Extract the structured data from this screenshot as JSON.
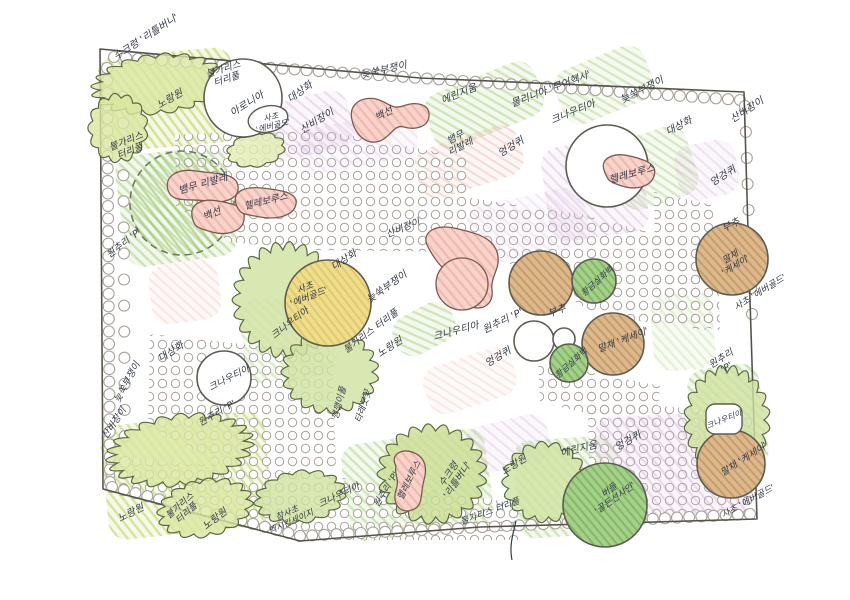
{
  "title": "planting-plan-sketch",
  "colors": {
    "ink": "#353b47",
    "outline": "#5d5c52",
    "border": "#55544c",
    "dot_stroke": "#a8a29a",
    "solid": {
      "green": "#b9d98e",
      "ygreen": "#d6e593",
      "pink": "#f3c1ba",
      "purple": "#dec2e4",
      "tan": "#d9b388",
      "yellow": "#efdd92"
    },
    "hatch": {
      "green": "#8fbf5e",
      "ygreen": "#b6cd55",
      "pink": "#e69a8e",
      "purple": "#c9a0d0",
      "tan": "#b5854e",
      "yellow": "#d8bb4e",
      "dkgreen": "#63a552"
    }
  },
  "plan": {
    "border": "100,49 420,78 744,92 750,300 757,519 480,527 300,541 103,489",
    "patches": [
      {
        "x": 100,
        "y": 52,
        "w": 135,
        "h": 95,
        "rot": -5,
        "c": "ygreen",
        "o": 0.55,
        "over": false
      },
      {
        "x": 120,
        "y": 150,
        "w": 112,
        "h": 112,
        "rot": -8,
        "c": "green",
        "o": 0.4,
        "over": false
      },
      {
        "x": 252,
        "y": 98,
        "w": 100,
        "h": 58,
        "rot": -14,
        "c": "purple",
        "o": 0.3,
        "over": true
      },
      {
        "x": 298,
        "y": 120,
        "w": 120,
        "h": 46,
        "rot": -10,
        "c": "purple",
        "o": 0.2,
        "over": true
      },
      {
        "x": 425,
        "y": 76,
        "w": 118,
        "h": 58,
        "rot": -22,
        "c": "green",
        "o": 0.35,
        "over": false
      },
      {
        "x": 556,
        "y": 56,
        "w": 96,
        "h": 58,
        "rot": -22,
        "c": "green",
        "o": 0.3,
        "over": false
      },
      {
        "x": 545,
        "y": 142,
        "w": 100,
        "h": 95,
        "rot": -8,
        "c": "purple",
        "o": 0.3,
        "over": true
      },
      {
        "x": 415,
        "y": 136,
        "w": 108,
        "h": 52,
        "rot": -18,
        "c": "pink",
        "o": 0.3,
        "over": false
      },
      {
        "x": 614,
        "y": 132,
        "w": 80,
        "h": 72,
        "rot": -18,
        "c": "green",
        "o": 0.3,
        "over": false
      },
      {
        "x": 676,
        "y": 142,
        "w": 62,
        "h": 56,
        "rot": -12,
        "c": "purple",
        "o": 0.25,
        "over": false
      },
      {
        "x": 468,
        "y": 196,
        "w": 120,
        "h": 60,
        "rot": -12,
        "c": "purple",
        "o": 0.18,
        "over": true
      },
      {
        "x": 392,
        "y": 308,
        "w": 64,
        "h": 42,
        "rot": -28,
        "c": "green",
        "o": 0.35,
        "over": false
      },
      {
        "x": 242,
        "y": 296,
        "w": 92,
        "h": 84,
        "rot": -8,
        "c": "green",
        "o": 0.25,
        "over": false
      },
      {
        "x": 424,
        "y": 356,
        "w": 92,
        "h": 50,
        "rot": -18,
        "c": "pink",
        "o": 0.18,
        "over": false
      },
      {
        "x": 652,
        "y": 292,
        "w": 62,
        "h": 78,
        "rot": -4,
        "c": "green",
        "o": 0.2,
        "over": false
      },
      {
        "x": 104,
        "y": 418,
        "w": 165,
        "h": 115,
        "rot": -6,
        "c": "ygreen",
        "o": 0.5,
        "over": false
      },
      {
        "x": 345,
        "y": 436,
        "w": 145,
        "h": 98,
        "rot": -8,
        "c": "green",
        "o": 0.35,
        "over": false
      },
      {
        "x": 515,
        "y": 438,
        "w": 105,
        "h": 98,
        "rot": -4,
        "c": "green",
        "o": 0.35,
        "over": false
      },
      {
        "x": 596,
        "y": 414,
        "w": 155,
        "h": 102,
        "rot": -3,
        "c": "purple",
        "o": 0.35,
        "over": true
      },
      {
        "x": 465,
        "y": 420,
        "w": 85,
        "h": 48,
        "rot": -14,
        "c": "purple",
        "o": 0.25,
        "over": true
      },
      {
        "x": 692,
        "y": 366,
        "w": 72,
        "h": 105,
        "rot": -8,
        "c": "green",
        "o": 0.4,
        "over": false
      },
      {
        "x": 150,
        "y": 262,
        "w": 70,
        "h": 60,
        "rot": -8,
        "c": "pink",
        "o": 0.2,
        "over": false
      }
    ],
    "dot_areas": [
      "175,135 310,128 468,158 470,252 312,250 230,242 176,206",
      "470,198 585,215 700,246 706,330 600,316 522,272 468,236",
      "654,192 716,206 720,330 656,318",
      "150,334 332,354 336,470 232,470 148,428",
      "104,456 300,472 522,504 518,540 300,540 104,488",
      "588,400 756,414 757,518 590,514",
      "538,362 660,386 656,430 540,402"
    ],
    "edge_rows": [
      {
        "pts": [
          [
            114,
            57
          ],
          [
            740,
            100
          ]
        ],
        "step": 12,
        "r": 5.5
      },
      {
        "pts": [
          [
            107,
            68
          ],
          [
            110,
            482
          ]
        ],
        "step": 12.5,
        "r": 5.5
      },
      {
        "pts": [
          [
            112,
            487
          ],
          [
            300,
            536
          ],
          [
            750,
            514
          ]
        ],
        "step": 12,
        "r": 5.5
      },
      {
        "pts": [
          [
            745,
            106
          ],
          [
            752,
            314
          ]
        ],
        "step": 24,
        "r": 5.5
      },
      {
        "pts": [
          [
            123,
            97
          ],
          [
            125,
            462
          ]
        ],
        "step": 26,
        "r": 5.5
      }
    ],
    "shrubs": [
      {
        "cx": 158,
        "cy": 84,
        "rx": 58,
        "ry": 26,
        "rot": -6,
        "c": "#d9e6a0"
      },
      {
        "cx": 118,
        "cy": 128,
        "rx": 26,
        "ry": 30,
        "rot": 0,
        "c": "#d9e6a0"
      },
      {
        "cx": 256,
        "cy": 150,
        "rx": 26,
        "ry": 15,
        "rot": -10,
        "c": "#e2ecb2"
      },
      {
        "cx": 286,
        "cy": 300,
        "rx": 46,
        "ry": 50,
        "rot": 0,
        "c": "#cfe2a0"
      },
      {
        "cx": 330,
        "cy": 372,
        "rx": 42,
        "ry": 36,
        "rot": 0,
        "c": "#cfe2a0"
      },
      {
        "cx": 180,
        "cy": 450,
        "rx": 64,
        "ry": 31,
        "rot": -8,
        "c": "#d9e6a0"
      },
      {
        "cx": 205,
        "cy": 508,
        "rx": 42,
        "ry": 25,
        "rot": -12,
        "c": "#d9e6a0"
      },
      {
        "cx": 300,
        "cy": 497,
        "rx": 40,
        "ry": 23,
        "rot": -8,
        "c": "#cfe2a0"
      },
      {
        "cx": 432,
        "cy": 474,
        "rx": 47,
        "ry": 43,
        "rot": 0,
        "c": "#c9dd92"
      },
      {
        "cx": 545,
        "cy": 482,
        "rx": 37,
        "ry": 35,
        "rot": 0,
        "c": "#cfe2a0"
      },
      {
        "cx": 727,
        "cy": 420,
        "rx": 37,
        "ry": 47,
        "rot": 0,
        "c": "#cfe2a0"
      }
    ],
    "trees": [
      {
        "cx": 182,
        "cy": 203,
        "r": 52,
        "f": "hgreen",
        "dash": true
      },
      {
        "cx": 243,
        "cy": 98,
        "r": 39,
        "f": "white"
      },
      {
        "cx": 607,
        "cy": 166,
        "r": 41,
        "f": "white"
      },
      {
        "cx": 732,
        "cy": 259,
        "r": 36,
        "f": "tan"
      },
      {
        "cx": 328,
        "cy": 303,
        "r": 43,
        "f": "yellow"
      },
      {
        "cx": 541,
        "cy": 283,
        "r": 32,
        "f": "tan"
      },
      {
        "cx": 594,
        "cy": 281,
        "r": 22,
        "f": "green"
      },
      {
        "cx": 613,
        "cy": 344,
        "r": 31,
        "f": "tan"
      },
      {
        "cx": 534,
        "cy": 341,
        "r": 20,
        "f": "white"
      },
      {
        "cx": 564,
        "cy": 339,
        "r": 11,
        "f": "white"
      },
      {
        "cx": 569,
        "cy": 363,
        "r": 19,
        "f": "green"
      },
      {
        "cx": 224,
        "cy": 378,
        "r": 27,
        "f": "white"
      },
      {
        "cx": 605,
        "cy": 505,
        "r": 42,
        "f": "green"
      },
      {
        "cx": 731,
        "cy": 464,
        "r": 34,
        "f": "tan"
      }
    ],
    "ellipses": [
      {
        "cx": 268,
        "cy": 119,
        "rx": 20,
        "ry": 13,
        "rot": -12
      }
    ],
    "rects": [
      {
        "x": 706,
        "y": 404,
        "w": 36,
        "h": 30
      }
    ],
    "blobs": [
      {
        "d": "M352,120 C348,104 362,96 376,99 C388,102 392,110 403,106 C416,101 430,104 429,116 C428,128 414,130 404,127 C394,124 392,136 380,141 C366,146 355,134 352,120 Z"
      },
      {
        "d": "M428,247 C420,232 436,224 454,228 C472,232 492,236 497,252 C502,268 490,276 492,290 C494,304 482,312 470,306 C458,300 462,284 452,276 C442,268 436,262 428,247 Z"
      },
      {
        "d": "M168,190 C164,176 178,168 196,171 C214,174 236,172 238,186 C240,200 222,204 206,201 C190,198 172,204 168,190 Z"
      },
      {
        "d": "M192,216 C190,204 202,198 218,201 C234,204 246,206 244,220 C242,232 226,236 212,232 C198,228 194,228 192,216 Z"
      },
      {
        "d": "M236,204 C232,192 244,186 262,188 C280,190 298,192 296,204 C294,216 276,220 260,217 C246,214 240,216 236,204 Z"
      },
      {
        "d": "M604,170 C600,158 614,152 630,156 C646,160 658,164 654,176 C650,188 634,190 622,186 C610,182 608,182 604,170 Z"
      },
      {
        "d": "M396,466 C390,456 400,448 412,452 C424,456 428,466 424,480 C420,494 424,506 412,510 C400,514 392,504 396,490 C400,478 394,476 396,466 Z"
      }
    ],
    "pink_circles": [
      {
        "cx": 462,
        "cy": 284,
        "r": 26
      }
    ],
    "squiggles": [
      {
        "d": "M516,521 C513,534 509,546 512,560"
      }
    ],
    "labels": [
      {
        "t": "수크령 '리틀버니'",
        "x": 146,
        "y": 37,
        "r": -33
      },
      {
        "t": "노랑원",
        "x": 170,
        "y": 99,
        "r": -30
      },
      {
        "t": "불가리스\n터리풀",
        "x": 225,
        "y": 74,
        "r": -18,
        "fs": 9.5
      },
      {
        "t": "아로니아",
        "x": 247,
        "y": 104,
        "r": -32
      },
      {
        "t": "사초\n'에버골드'",
        "x": 272,
        "y": 121,
        "r": -14,
        "fs": 8
      },
      {
        "t": "대상화",
        "x": 300,
        "y": 92,
        "r": -36
      },
      {
        "t": "산비장이",
        "x": 317,
        "y": 121,
        "r": -32
      },
      {
        "t": "늦쑥부쟁이",
        "x": 384,
        "y": 70,
        "r": -13
      },
      {
        "t": "에린지움",
        "x": 459,
        "y": 94,
        "r": -22
      },
      {
        "t": "몰리니아 '무어헥사'",
        "x": 551,
        "y": 89,
        "r": -21
      },
      {
        "t": "크나우티아",
        "x": 573,
        "y": 112,
        "r": -22
      },
      {
        "t": "백선",
        "x": 384,
        "y": 114,
        "r": -28
      },
      {
        "t": "뱀무\n리발레",
        "x": 458,
        "y": 142,
        "r": -28,
        "fs": 9.5
      },
      {
        "t": "엉겅퀴",
        "x": 511,
        "y": 147,
        "r": -32
      },
      {
        "t": "늦쑥부쟁이",
        "x": 642,
        "y": 90,
        "r": -27
      },
      {
        "t": "산비장이",
        "x": 747,
        "y": 110,
        "r": -33
      },
      {
        "t": "대상화",
        "x": 679,
        "y": 126,
        "r": -28
      },
      {
        "t": "헬레보루스",
        "x": 632,
        "y": 174,
        "r": -16
      },
      {
        "t": "엉겅퀴",
        "x": 723,
        "y": 176,
        "r": -32
      },
      {
        "t": "부추",
        "x": 731,
        "y": 225,
        "r": -26
      },
      {
        "t": "말채\n'케세이'",
        "x": 733,
        "y": 261,
        "r": -32,
        "fs": 9
      },
      {
        "t": "사초 '에버골드'",
        "x": 760,
        "y": 292,
        "r": -32,
        "fs": 9
      },
      {
        "t": "불가리스\n터리풀",
        "x": 128,
        "y": 146,
        "r": -22,
        "fs": 9.5
      },
      {
        "t": "뱀무 리발레",
        "x": 203,
        "y": 184,
        "r": -16
      },
      {
        "t": "백선",
        "x": 212,
        "y": 214,
        "r": -24
      },
      {
        "t": "헬레보루스",
        "x": 266,
        "y": 201,
        "r": -14,
        "fs": 9.5
      },
      {
        "t": "원추리 'P'",
        "x": 124,
        "y": 243,
        "r": -38,
        "fs": 9.5
      },
      {
        "t": "산비장이",
        "x": 403,
        "y": 228,
        "r": -22,
        "fs": 9.5
      },
      {
        "t": "대상화",
        "x": 344,
        "y": 260,
        "r": -33
      },
      {
        "t": "사초\n'에버골드'",
        "x": 307,
        "y": 292,
        "r": -22,
        "fs": 9
      },
      {
        "t": "크나우티아",
        "x": 290,
        "y": 323,
        "r": -38,
        "fs": 9.5
      },
      {
        "t": "늦쑥부쟁이",
        "x": 387,
        "y": 287,
        "r": -36
      },
      {
        "t": "불가리스 터리풀",
        "x": 371,
        "y": 331,
        "r": -37,
        "fs": 9.5
      },
      {
        "t": "노랑원",
        "x": 390,
        "y": 347,
        "r": -33
      },
      {
        "t": "크나우티아",
        "x": 456,
        "y": 331,
        "r": -15
      },
      {
        "t": "원추리 'P'",
        "x": 503,
        "y": 321,
        "r": -26
      },
      {
        "t": "부추",
        "x": 557,
        "y": 311,
        "r": -22
      },
      {
        "t": "엉겅퀴",
        "x": 498,
        "y": 357,
        "r": -31
      },
      {
        "t": "황금실화백",
        "x": 597,
        "y": 281,
        "r": -42,
        "fs": 8.5
      },
      {
        "t": "말채 '케세이'",
        "x": 623,
        "y": 340,
        "r": -21,
        "fs": 9.5
      },
      {
        "t": "황금실화백",
        "x": 571,
        "y": 363,
        "r": -42,
        "fs": 8.5
      },
      {
        "t": "원추리\n'P'",
        "x": 724,
        "y": 363,
        "r": -33,
        "fs": 9.5
      },
      {
        "t": "대상화",
        "x": 171,
        "y": 352,
        "r": -32
      },
      {
        "t": "늦쑥부쟁이",
        "x": 127,
        "y": 382,
        "r": -62,
        "fs": 9.5
      },
      {
        "t": "산비장이",
        "x": 114,
        "y": 423,
        "r": -56,
        "fs": 9.5
      },
      {
        "t": "크나우티아",
        "x": 229,
        "y": 378,
        "r": -27,
        "fs": 9.5
      },
      {
        "t": "원추리 'P'",
        "x": 217,
        "y": 413,
        "r": -30,
        "fs": 9.5
      },
      {
        "t": "깽깽이풀",
        "x": 339,
        "y": 403,
        "r": -76,
        "fs": 9
      },
      {
        "t": "타래붓꽃",
        "x": 363,
        "y": 406,
        "r": -72,
        "fs": 9
      },
      {
        "t": "노랑원",
        "x": 131,
        "y": 513,
        "r": -27
      },
      {
        "t": "불가리스\n터리풀",
        "x": 183,
        "y": 509,
        "r": -42,
        "fs": 9
      },
      {
        "t": "노랑원",
        "x": 215,
        "y": 519,
        "r": -38
      },
      {
        "t": "참사초\n멕시칸세이지",
        "x": 289,
        "y": 517,
        "r": -24,
        "fs": 8.5
      },
      {
        "t": "크나우티아",
        "x": 339,
        "y": 495,
        "r": -26,
        "fs": 9.5
      },
      {
        "t": "원추리 'P'",
        "x": 386,
        "y": 489,
        "r": -58,
        "fs": 9
      },
      {
        "t": "헬레보루스",
        "x": 409,
        "y": 480,
        "r": -64,
        "fs": 9
      },
      {
        "t": "수크령\n'리틀버니'",
        "x": 453,
        "y": 477,
        "r": -56,
        "fs": 9.5
      },
      {
        "t": "노랑원",
        "x": 514,
        "y": 465,
        "r": -32
      },
      {
        "t": "에린지움",
        "x": 579,
        "y": 449,
        "r": -14
      },
      {
        "t": "불가리스 터리풀",
        "x": 490,
        "y": 511,
        "r": -20,
        "fs": 9
      },
      {
        "t": "버들\n'골든선샤인'",
        "x": 612,
        "y": 494,
        "r": -36,
        "fs": 9
      },
      {
        "t": "엉겅퀴",
        "x": 628,
        "y": 441,
        "r": -30
      },
      {
        "t": "크나우티아",
        "x": 724,
        "y": 419,
        "r": -22,
        "fs": 8
      },
      {
        "t": "말채 '케세이'",
        "x": 744,
        "y": 459,
        "r": -33,
        "fs": 9.5
      },
      {
        "t": "사초 '에버골드'",
        "x": 748,
        "y": 501,
        "r": -29,
        "fs": 9
      }
    ]
  }
}
